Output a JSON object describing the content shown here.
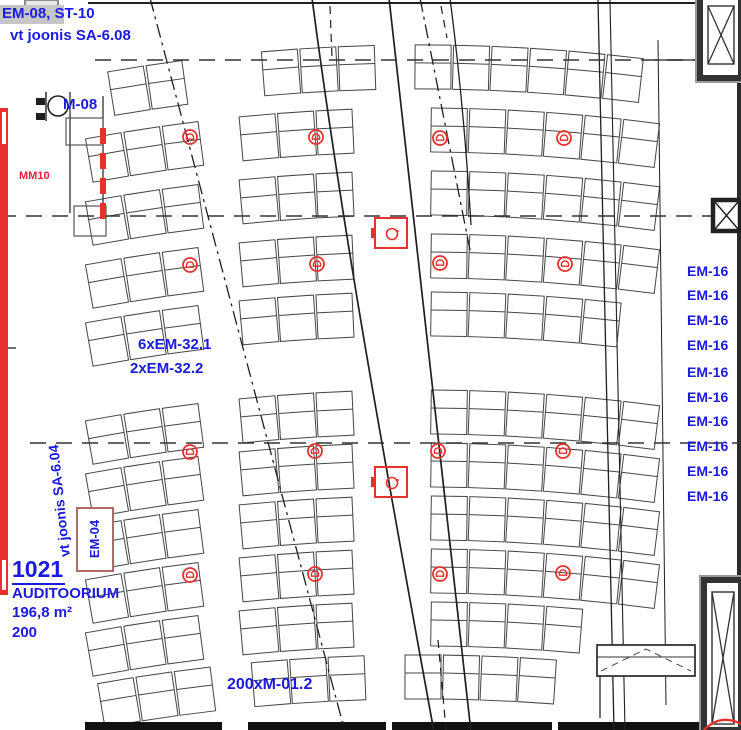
{
  "colors": {
    "annotation_blue": "#1a1ae0",
    "device_red": "#e8312f",
    "marker_red": "#e8203c",
    "em04_box": "#b36868",
    "line_dark": "#1f1f1f"
  },
  "annotations": {
    "header_tag": "EM-08, ST-10",
    "header_ref": "vt joonis SA-6.08",
    "m08": "M-08",
    "mm10": "MM10",
    "em32_1": "6xEM-32.1",
    "em32_2": "2xEM-32.2",
    "m012": "200xM-01.2",
    "em04": "EM-04",
    "side_ref": "vt joonis SA-6.04",
    "em16": [
      "EM-16",
      "EM-16",
      "EM-16",
      "EM-16",
      "EM-16",
      "EM-16",
      "EM-16",
      "EM-16",
      "EM-16",
      "EM-16"
    ]
  },
  "room": {
    "number": "1021",
    "name": "AUDITOORIUM",
    "area": "196,8 m²",
    "capacity": "200"
  },
  "devices": {
    "speakers": [
      [
        190,
        137
      ],
      [
        316,
        137
      ],
      [
        440,
        138
      ],
      [
        564,
        138
      ],
      [
        190,
        265
      ],
      [
        317,
        264
      ],
      [
        440,
        263
      ],
      [
        565,
        264
      ],
      [
        190,
        452
      ],
      [
        315,
        451
      ],
      [
        438,
        451
      ],
      [
        563,
        451
      ],
      [
        190,
        575
      ],
      [
        315,
        574
      ],
      [
        440,
        574
      ],
      [
        563,
        573
      ]
    ],
    "floor_boxes": [
      [
        391,
        233
      ],
      [
        391,
        482
      ]
    ]
  }
}
